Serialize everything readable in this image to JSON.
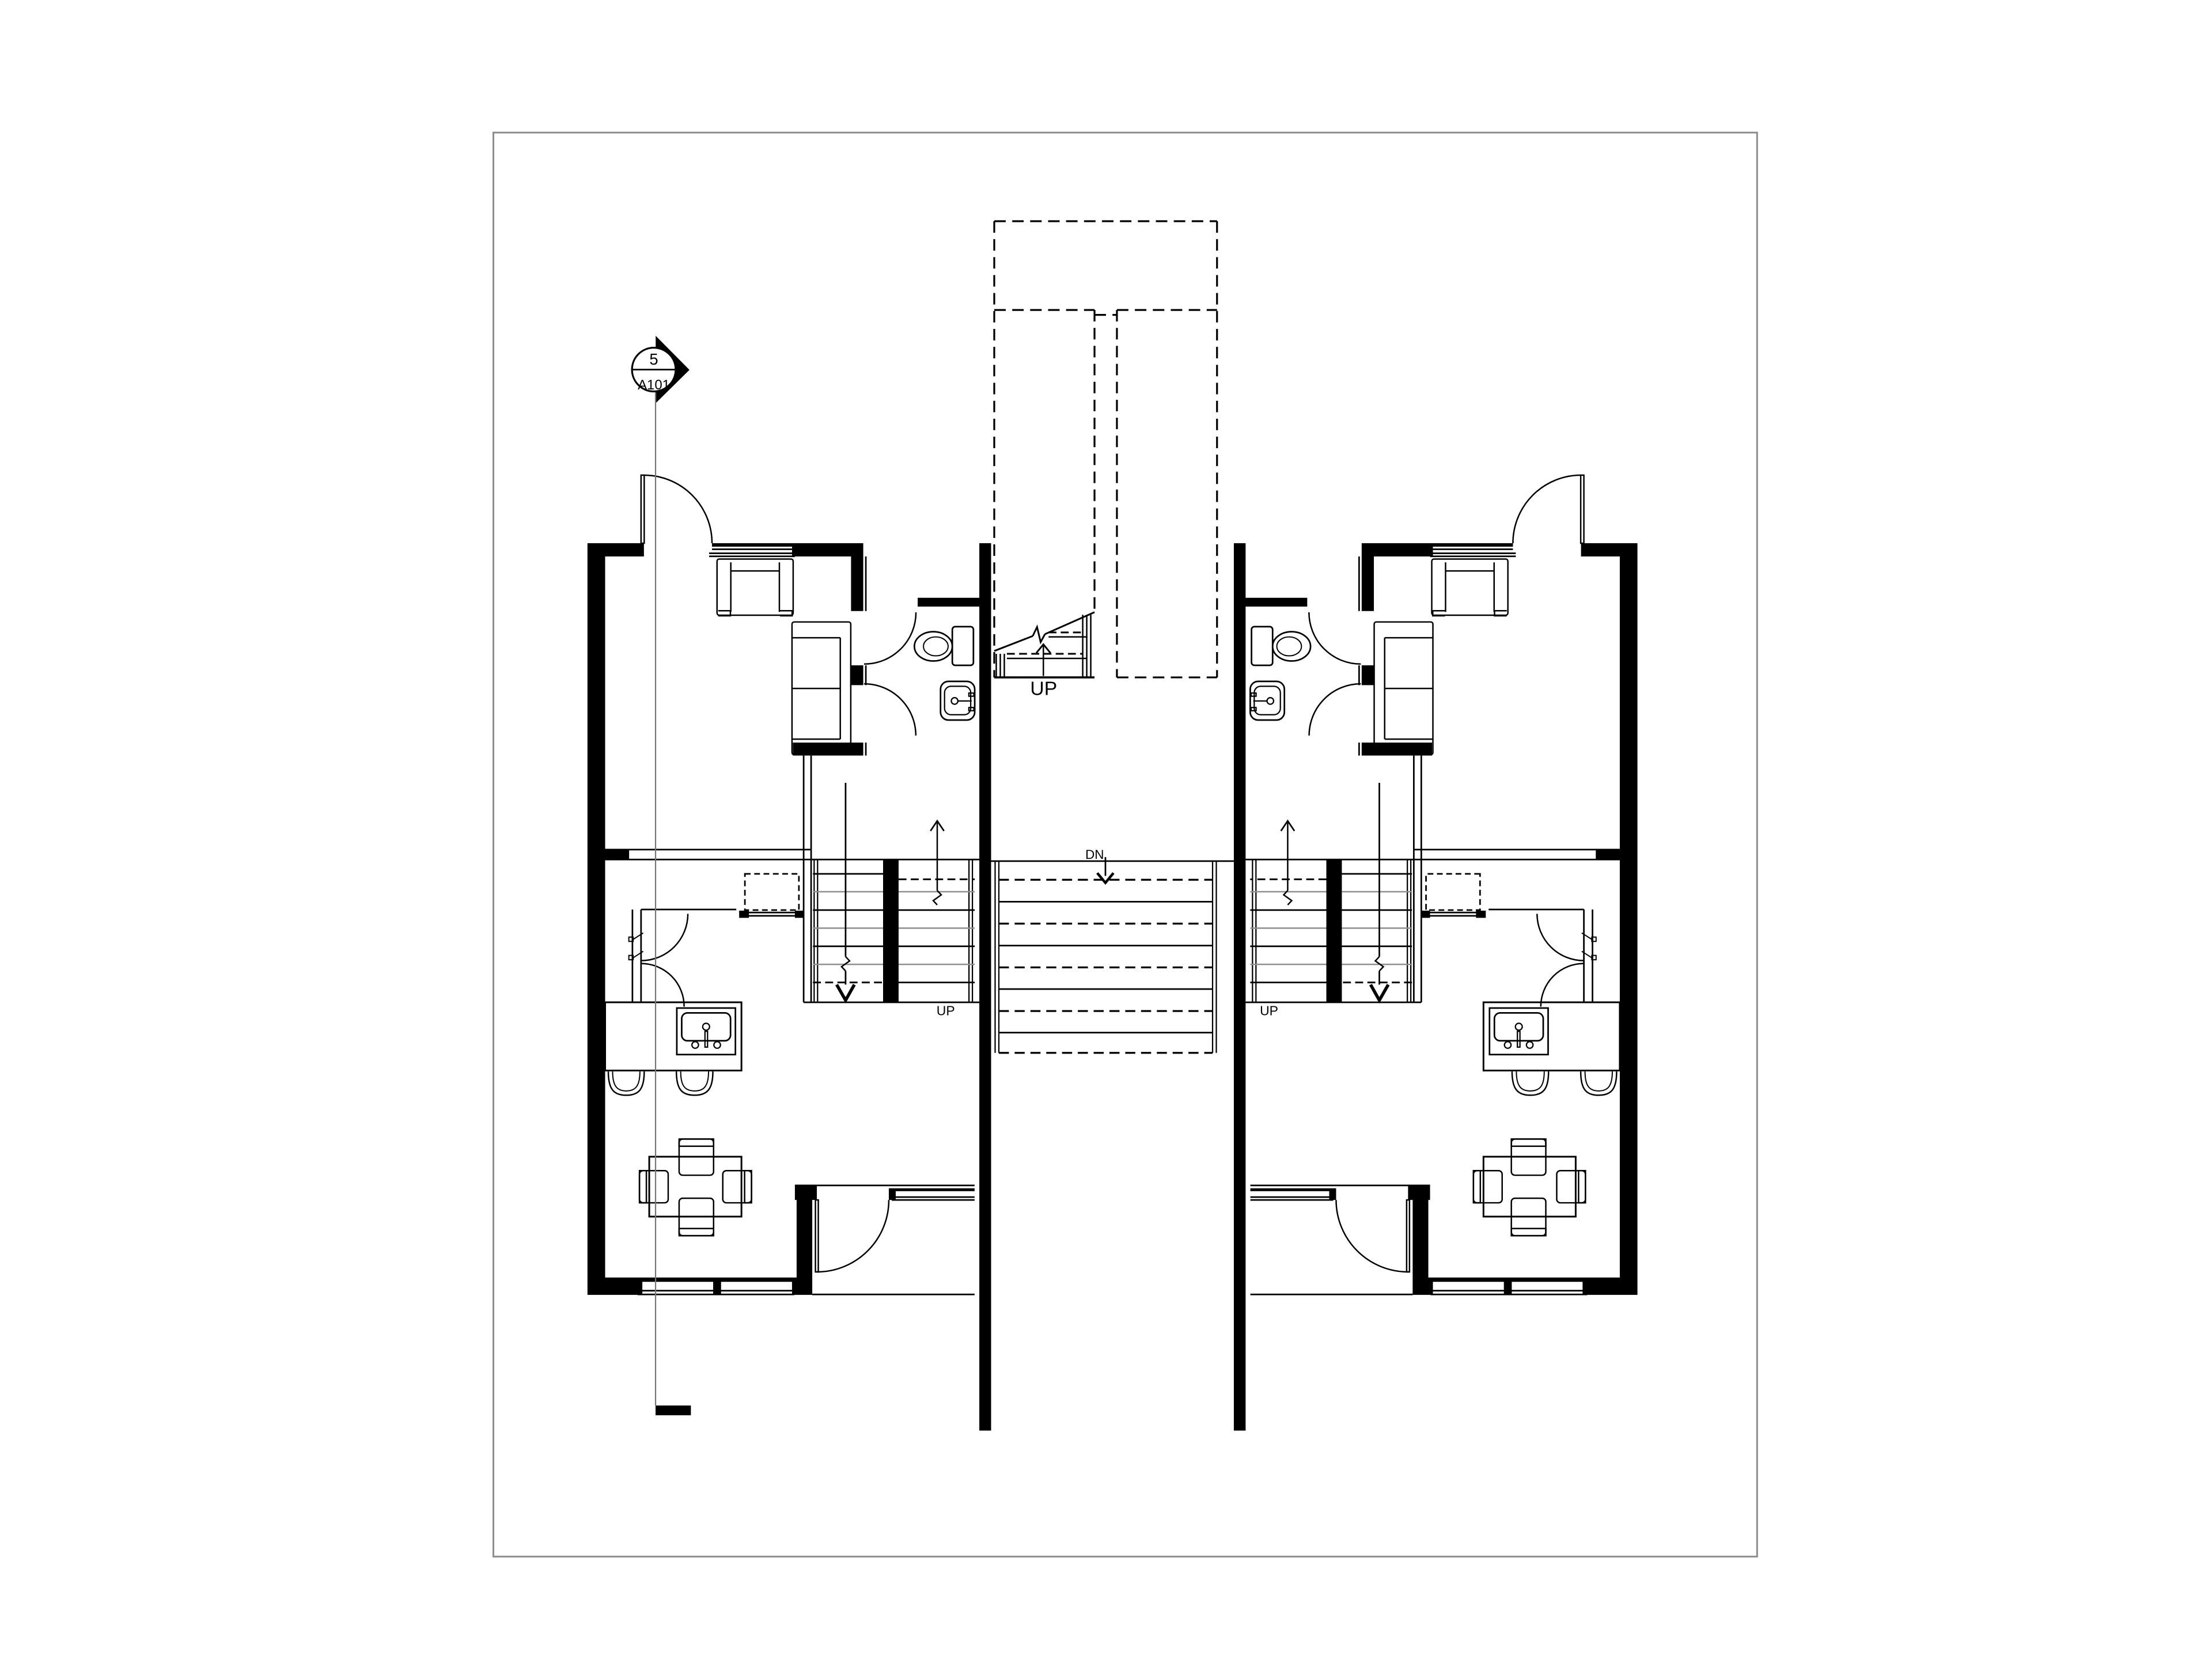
{
  "sheet": {
    "background": "#ffffff",
    "border_color": "#8c8c8c"
  },
  "colors": {
    "linework": "#000000",
    "wall_fill": "#000000",
    "muted_line": "#8f8f8f",
    "section_line": "#777777"
  },
  "section_marker": {
    "detail_number": "5",
    "sheet_number": "A101"
  },
  "stair_labels": {
    "entry_up": "UP",
    "central_down": "DN",
    "left_unit_up": "UP",
    "right_unit_up": "UP"
  }
}
